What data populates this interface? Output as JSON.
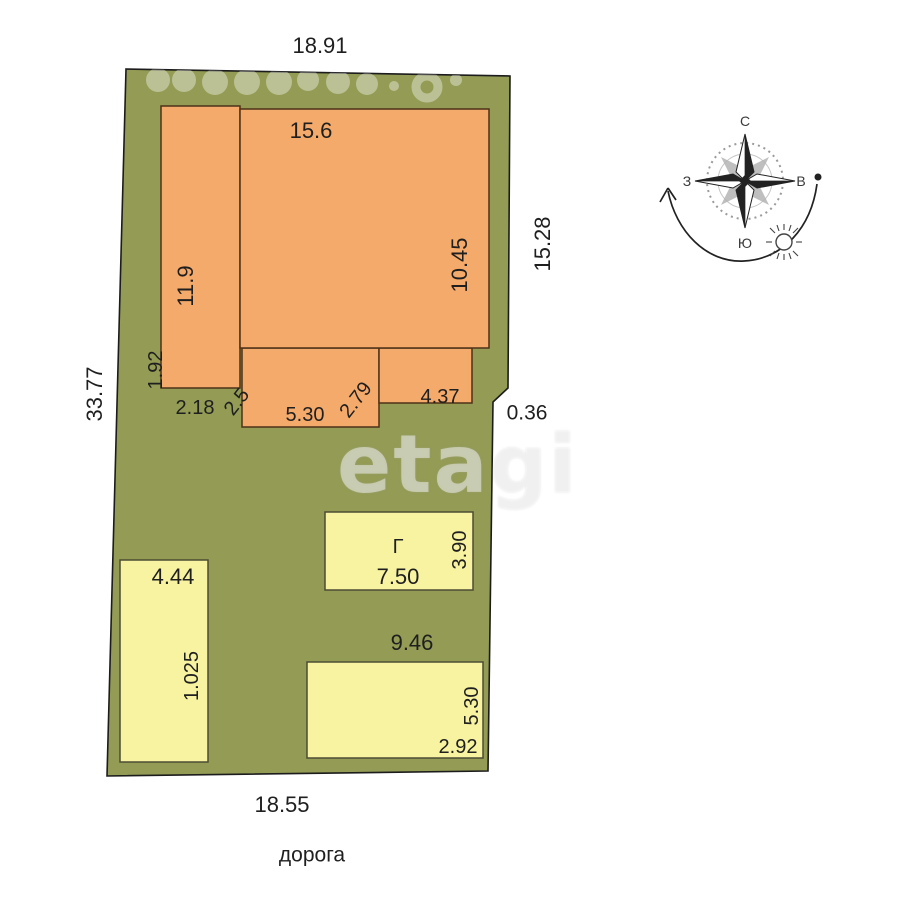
{
  "site_plan": {
    "plot": {
      "width_top": "18.91",
      "length_left": "33.77",
      "length_right": "15.28",
      "notch_right": "0.36",
      "width_bottom": "18.55",
      "road": "дорога",
      "fill_color": "#939B55"
    },
    "house": {
      "fill_color": "#F4AA6A",
      "main_width_top": "15.6",
      "main_height_right": "10.45",
      "left_wing_height": "11.9",
      "left_wing_bottom": "1.92",
      "setback_left": "2.18",
      "gap": "2.5",
      "porch_width": "5.30",
      "porch_side": "2.79",
      "annex_width": "4.37"
    },
    "outbuildings": {
      "fill_color": "#F7F3A1",
      "garage": {
        "letter": "Г",
        "width": "7.50",
        "height": "3.90"
      },
      "left_shed": {
        "width": "4.44",
        "height": "1.025"
      },
      "bottom_shed": {
        "width": "9.46",
        "height": "5.30",
        "offset": "2.92"
      }
    },
    "compass": {
      "north": "С",
      "south": "Ю",
      "west": "З",
      "east": "В"
    },
    "watermark": "etagi"
  }
}
